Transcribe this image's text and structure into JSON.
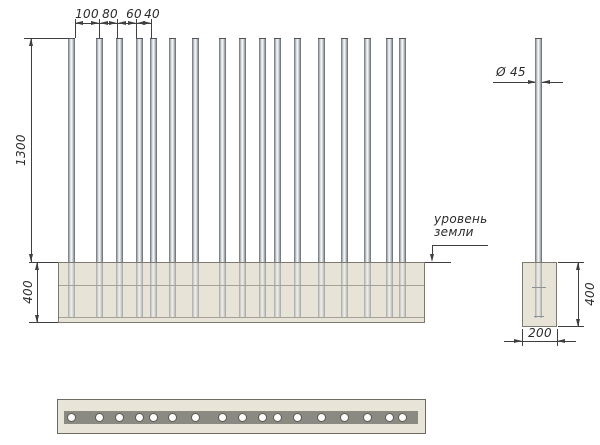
{
  "drawing_type": "fence-section-technical-drawing",
  "colors": {
    "line": "#3f3f3f",
    "foundation_fill": "#e8e3d7",
    "foundation_border": "#7d796f",
    "plan_strip_fill": "#8a8a82",
    "hole_fill": "#ffffff",
    "pole_edge": "#62686e",
    "pole_highlight": "#f8fafb",
    "text": "#2b2b2b"
  },
  "front_view": {
    "spacing_labels": [
      "100",
      "80",
      "60",
      "40"
    ],
    "pole_height_label": "1300",
    "foundation_depth_label": "400",
    "ground_note_line1": "уровень",
    "ground_note_line2": "земли",
    "pole_count": 17,
    "pole_x": [
      68,
      96,
      116,
      136,
      150,
      169,
      192,
      219,
      239,
      259,
      274,
      294,
      318,
      341,
      364,
      386,
      399
    ],
    "pole_width_px": 7,
    "pole_top_y": 38,
    "ground_y": 262,
    "foundation_bottom_y": 323
  },
  "side_view": {
    "diameter_label": "Ø 45",
    "depth_label": "400",
    "width_label": "200"
  },
  "plan_view": {
    "hole_count": 17
  }
}
